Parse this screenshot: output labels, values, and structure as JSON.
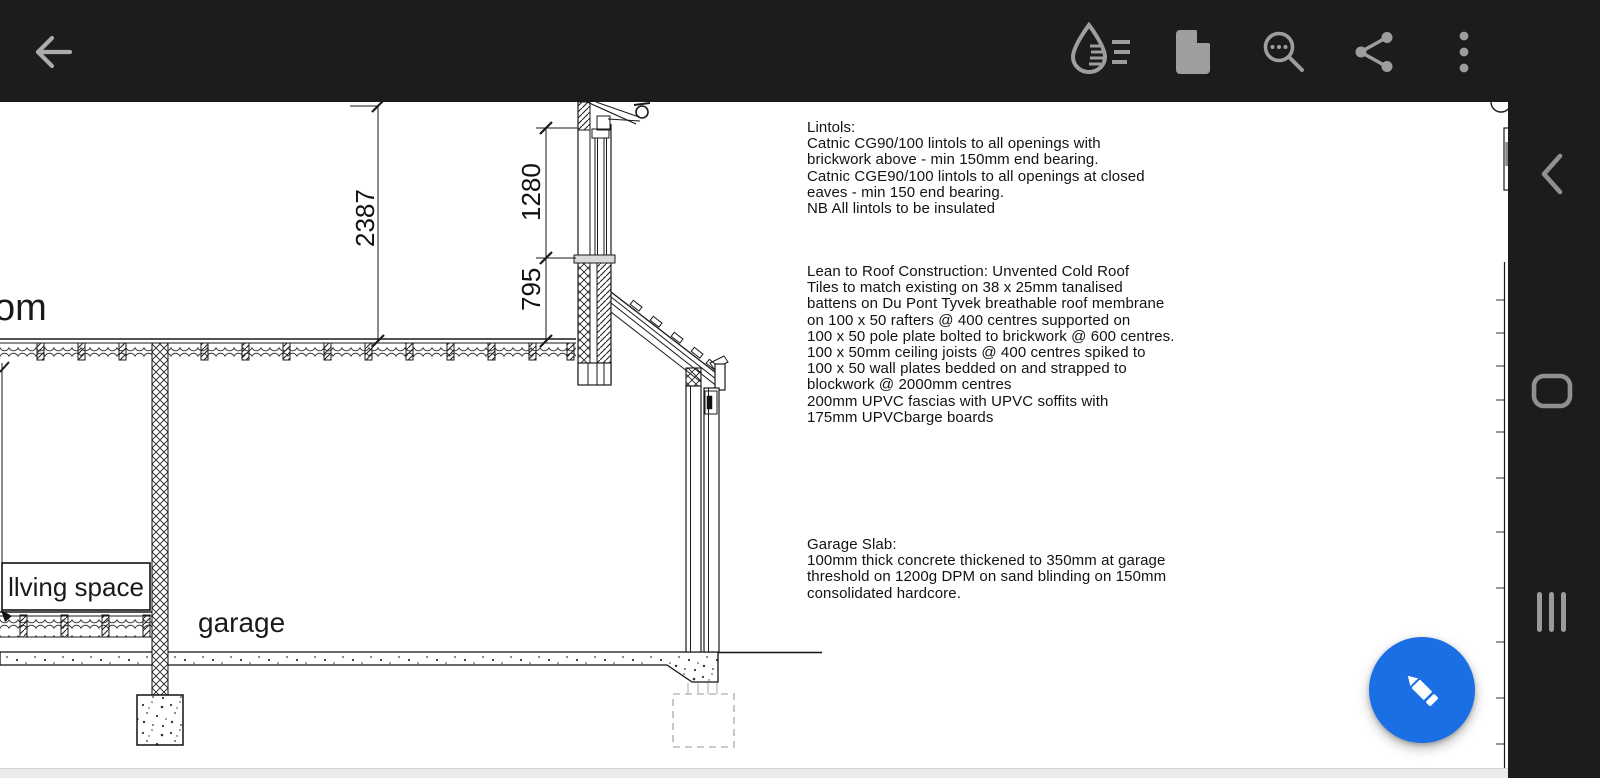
{
  "toolbar": {
    "icons": {
      "back": "back-arrow",
      "ink": "ink-annotation",
      "pages": "page-thumbnail",
      "search": "search-in-document",
      "share": "share",
      "more": "overflow-menu"
    }
  },
  "notes": {
    "lintols": {
      "lines": [
        "Lintols:",
        "Catnic CG90/100 lintols to all openings with",
        "brickwork above - min 150mm end bearing.",
        "Catnic CGE90/100 lintols to all openings at closed",
        "eaves - min 150 end bearing.",
        "NB All lintols to be insulated"
      ]
    },
    "lean_roof": {
      "lines": [
        "Lean to Roof Construction: Unvented Cold Roof",
        "Tiles to match existing on 38 x 25mm tanalised",
        "battens on Du Pont Tyvek breathable roof membrane",
        "on 100 x 50 rafters @ 400 centres supported on",
        "100 x 50 pole plate bolted to brickwork @ 600 centres.",
        "100 x 50mm ceiling joists @ 400 centres spiked to",
        "100 x 50 wall plates bedded on and strapped to",
        "blockwork @ 2000mm centres",
        "200mm UPVC fascias with UPVC soffits with",
        "175mm UPVCbarge boards"
      ]
    },
    "garage_slab": {
      "lines": [
        "Garage Slab:",
        "100mm thick concrete thickened to 350mm at garage",
        "threshold on 1200g DPM on sand blinding on 150mm",
        "consolidated hardcore."
      ]
    }
  },
  "drawing": {
    "labels": {
      "room_partial": "om",
      "living_space": "llving space",
      "garage": "garage"
    },
    "dimensions": {
      "floor_to_ceiling": "2387",
      "glazing_height": "1280",
      "sill_height": "795"
    }
  },
  "fab": {
    "action": "edit"
  },
  "nav": {
    "buttons": [
      "back",
      "home",
      "recents"
    ]
  },
  "colors": {
    "bar_bg": "#1c1c1c",
    "icon_gray": "#9e9e9e",
    "fab_blue": "#1a6fe4"
  }
}
